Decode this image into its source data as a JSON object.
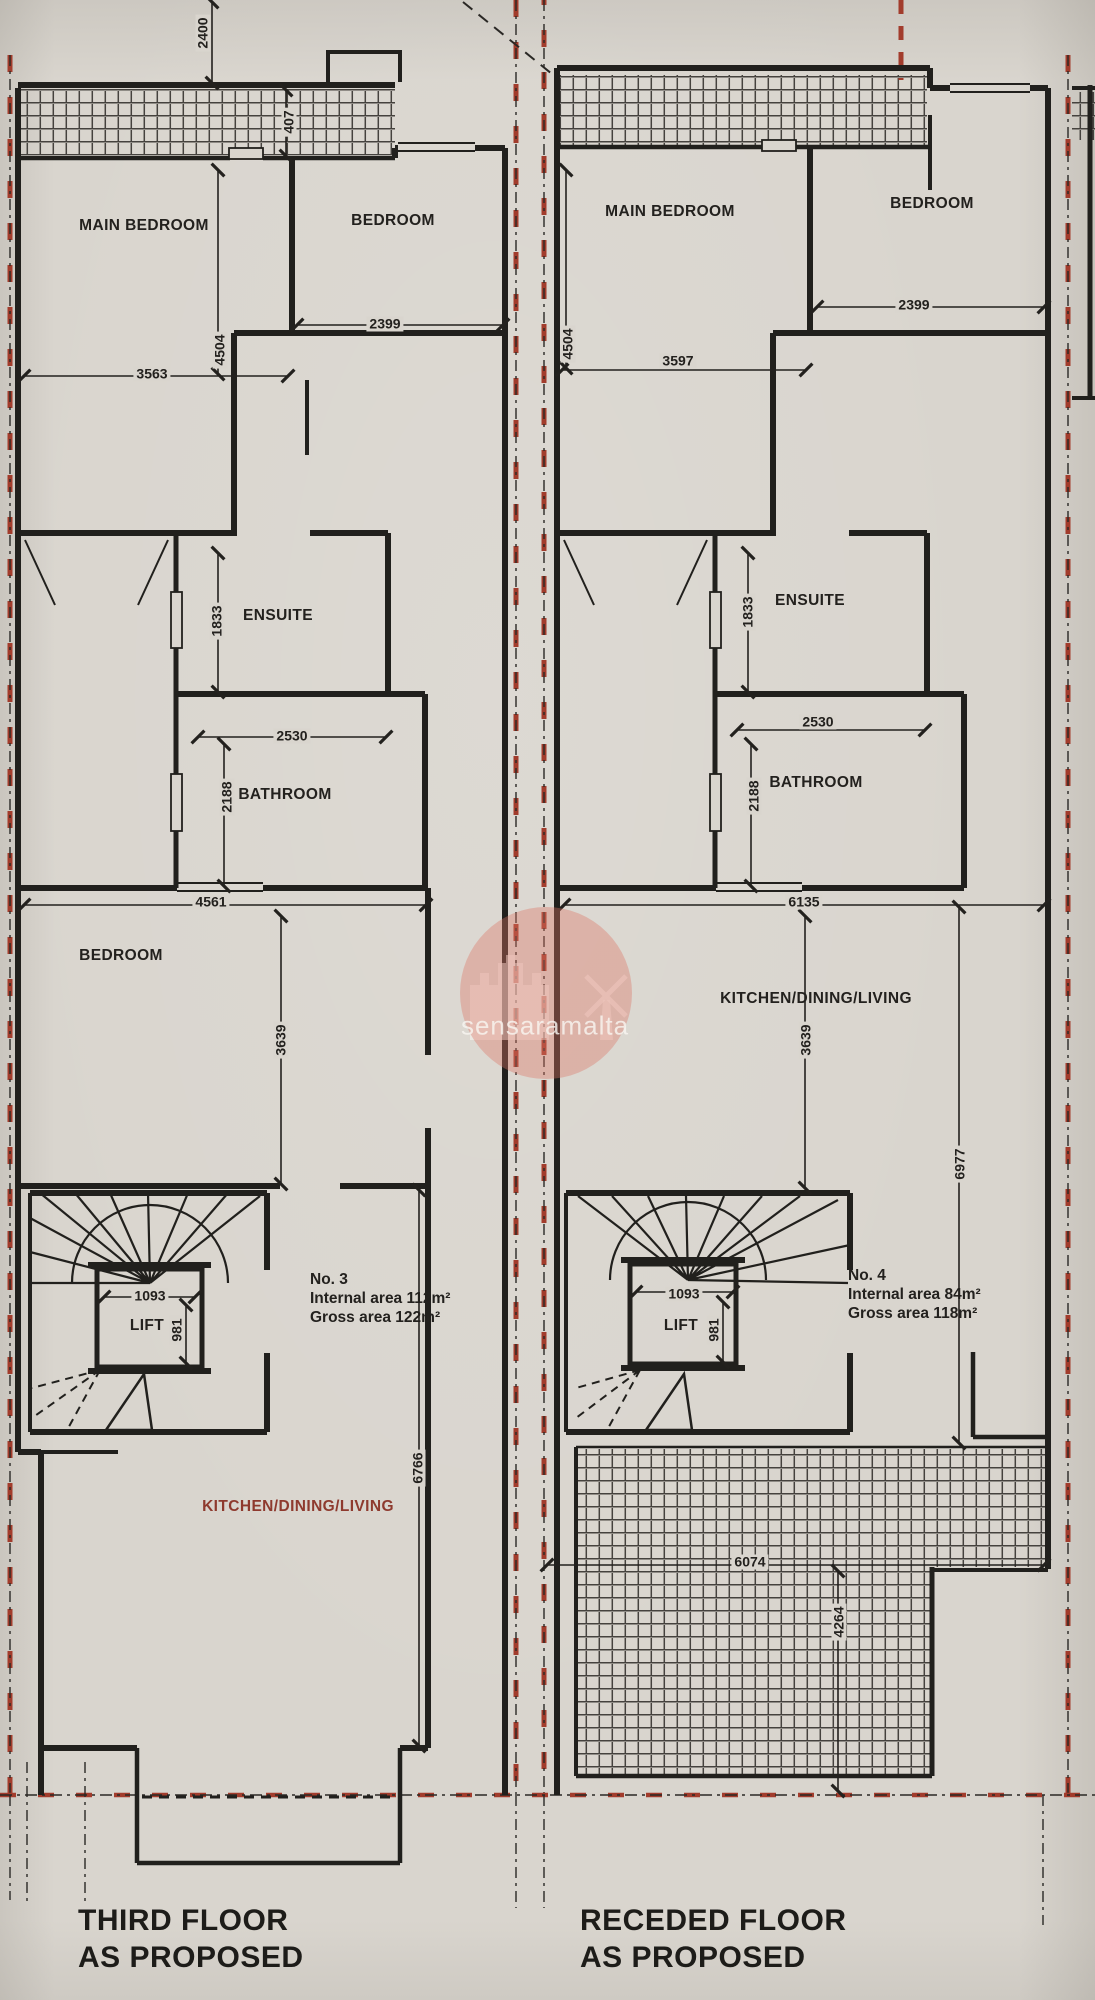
{
  "watermark": {
    "text": "sensaramalta"
  },
  "colors": {
    "paper": "#d9d5ce",
    "ink": "#21201d",
    "boundary_red": "#a23c2c",
    "label_red": "#8e3a2e"
  },
  "left_plan": {
    "title": [
      "THIRD FLOOR",
      "AS PROPOSED"
    ],
    "unit": {
      "number": "No. 3",
      "internal_area": "Internal area 112m²",
      "gross_area": "Gross area 122m²"
    },
    "rooms": {
      "main_bedroom": "MAIN BEDROOM",
      "bedroom_front": "BEDROOM",
      "ensuite": "ENSUITE",
      "bathroom": "BATHROOM",
      "bedroom_rear": "BEDROOM",
      "kitchen": "KITCHEN/DINING/LIVING",
      "lift": "LIFT"
    },
    "dims": {
      "d2400": "2400",
      "d407": "407",
      "d3563": "3563",
      "d4504": "4504",
      "d2399": "2399",
      "d1833": "1833",
      "d2530": "2530",
      "d2188": "2188",
      "d4561": "4561",
      "d3639": "3639",
      "d1093": "1093",
      "d981": "981",
      "d6766": "6766"
    }
  },
  "right_plan": {
    "title": [
      "RECEDED FLOOR",
      "AS PROPOSED"
    ],
    "unit": {
      "number": "No. 4",
      "internal_area": "Internal area 84m²",
      "gross_area": "Gross area 118m²"
    },
    "rooms": {
      "main_bedroom": "MAIN BEDROOM",
      "bedroom_front": "BEDROOM",
      "ensuite": "ENSUITE",
      "bathroom": "BATHROOM",
      "kitchen": "KITCHEN/DINING/LIVING",
      "lift": "LIFT"
    },
    "dims": {
      "d4504": "4504",
      "d3597": "3597",
      "d2399": "2399",
      "d1833": "1833",
      "d2530": "2530",
      "d2188": "2188",
      "d6135": "6135",
      "d3639": "3639",
      "d6977": "6977",
      "d1093": "1093",
      "d981": "981",
      "d6074": "6074",
      "d4264": "4264"
    }
  }
}
